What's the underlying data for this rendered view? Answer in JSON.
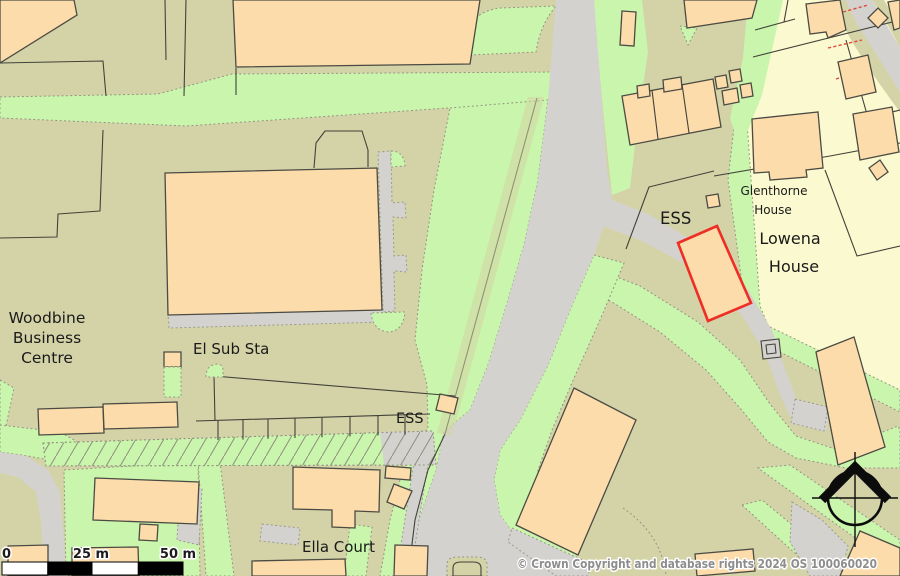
{
  "map": {
    "labels": {
      "woodbine": [
        "Woodbine",
        "Business",
        "Centre"
      ],
      "el_sub_sta": "El Sub Sta",
      "ess_upper": "ESS",
      "ess_lower": "ESS",
      "ella_court": "Ella Court",
      "glenthorne": [
        "Glenthorne",
        "House"
      ],
      "lowena": [
        "Lowena",
        "House"
      ]
    },
    "scale_bar": {
      "start": "0",
      "mid": "25 m",
      "end": "50 m"
    },
    "copyright": "© Crown Copyright and database rights 2024 OS 100060020",
    "north_arrow": "compass-north",
    "palette": {
      "background": "#d4d3a8",
      "grass": "#c9f5ac",
      "road": "#d3d2cf",
      "building_fill": "#fddcab",
      "building_stroke": "#4b4b43",
      "residential": "#fbf9cf",
      "highlight_red": "#ee2e24",
      "boundary_dotted": "#90907f",
      "label_text": "#1a1a1a",
      "copyright_text": "#8d8d8d"
    }
  }
}
